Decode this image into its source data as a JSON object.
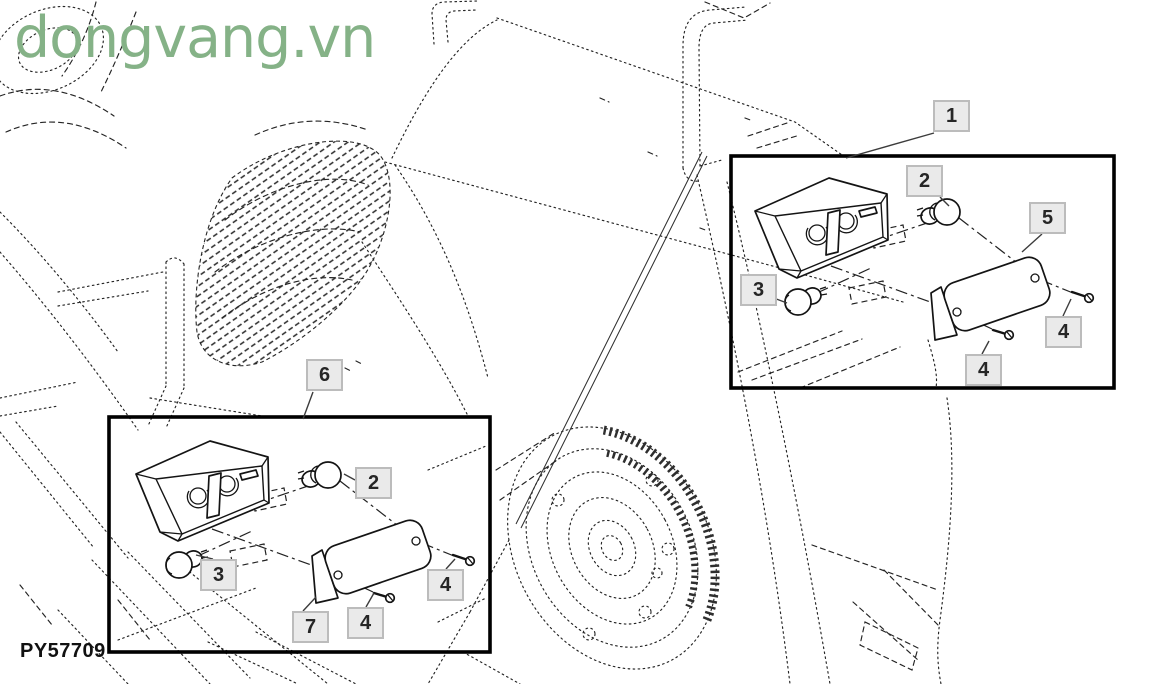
{
  "watermark": {
    "text": "dongvang.vn",
    "color": "#85b287"
  },
  "diagram": {
    "part_code": "PY57709",
    "inset_panels": [
      {
        "id": "right-lamp-assembly",
        "callout_labels": [
          "1",
          "2",
          "5",
          "3",
          "4",
          "4"
        ]
      },
      {
        "id": "left-lamp-assembly",
        "callout_labels": [
          "6",
          "2",
          "3",
          "7",
          "4",
          "4"
        ]
      }
    ]
  },
  "callouts": [
    {
      "group": "right-lamp",
      "label": "1"
    },
    {
      "group": "right-lamp",
      "label": "2"
    },
    {
      "group": "right-lamp",
      "label": "5"
    },
    {
      "group": "right-lamp",
      "label": "3"
    },
    {
      "group": "right-lamp",
      "label": "4"
    },
    {
      "group": "right-lamp",
      "label": "4"
    },
    {
      "group": "left-lamp",
      "label": "6"
    },
    {
      "group": "left-lamp",
      "label": "2"
    },
    {
      "group": "left-lamp",
      "label": "3"
    },
    {
      "group": "left-lamp",
      "label": "7"
    },
    {
      "group": "left-lamp",
      "label": "4"
    },
    {
      "group": "left-lamp",
      "label": "4"
    }
  ],
  "colors": {
    "watermark_green": "#85b287",
    "callout_bg": "#eaeaea",
    "callout_border": "#bcbcbc",
    "line_art": "#242424",
    "inset_border": "#000000"
  }
}
